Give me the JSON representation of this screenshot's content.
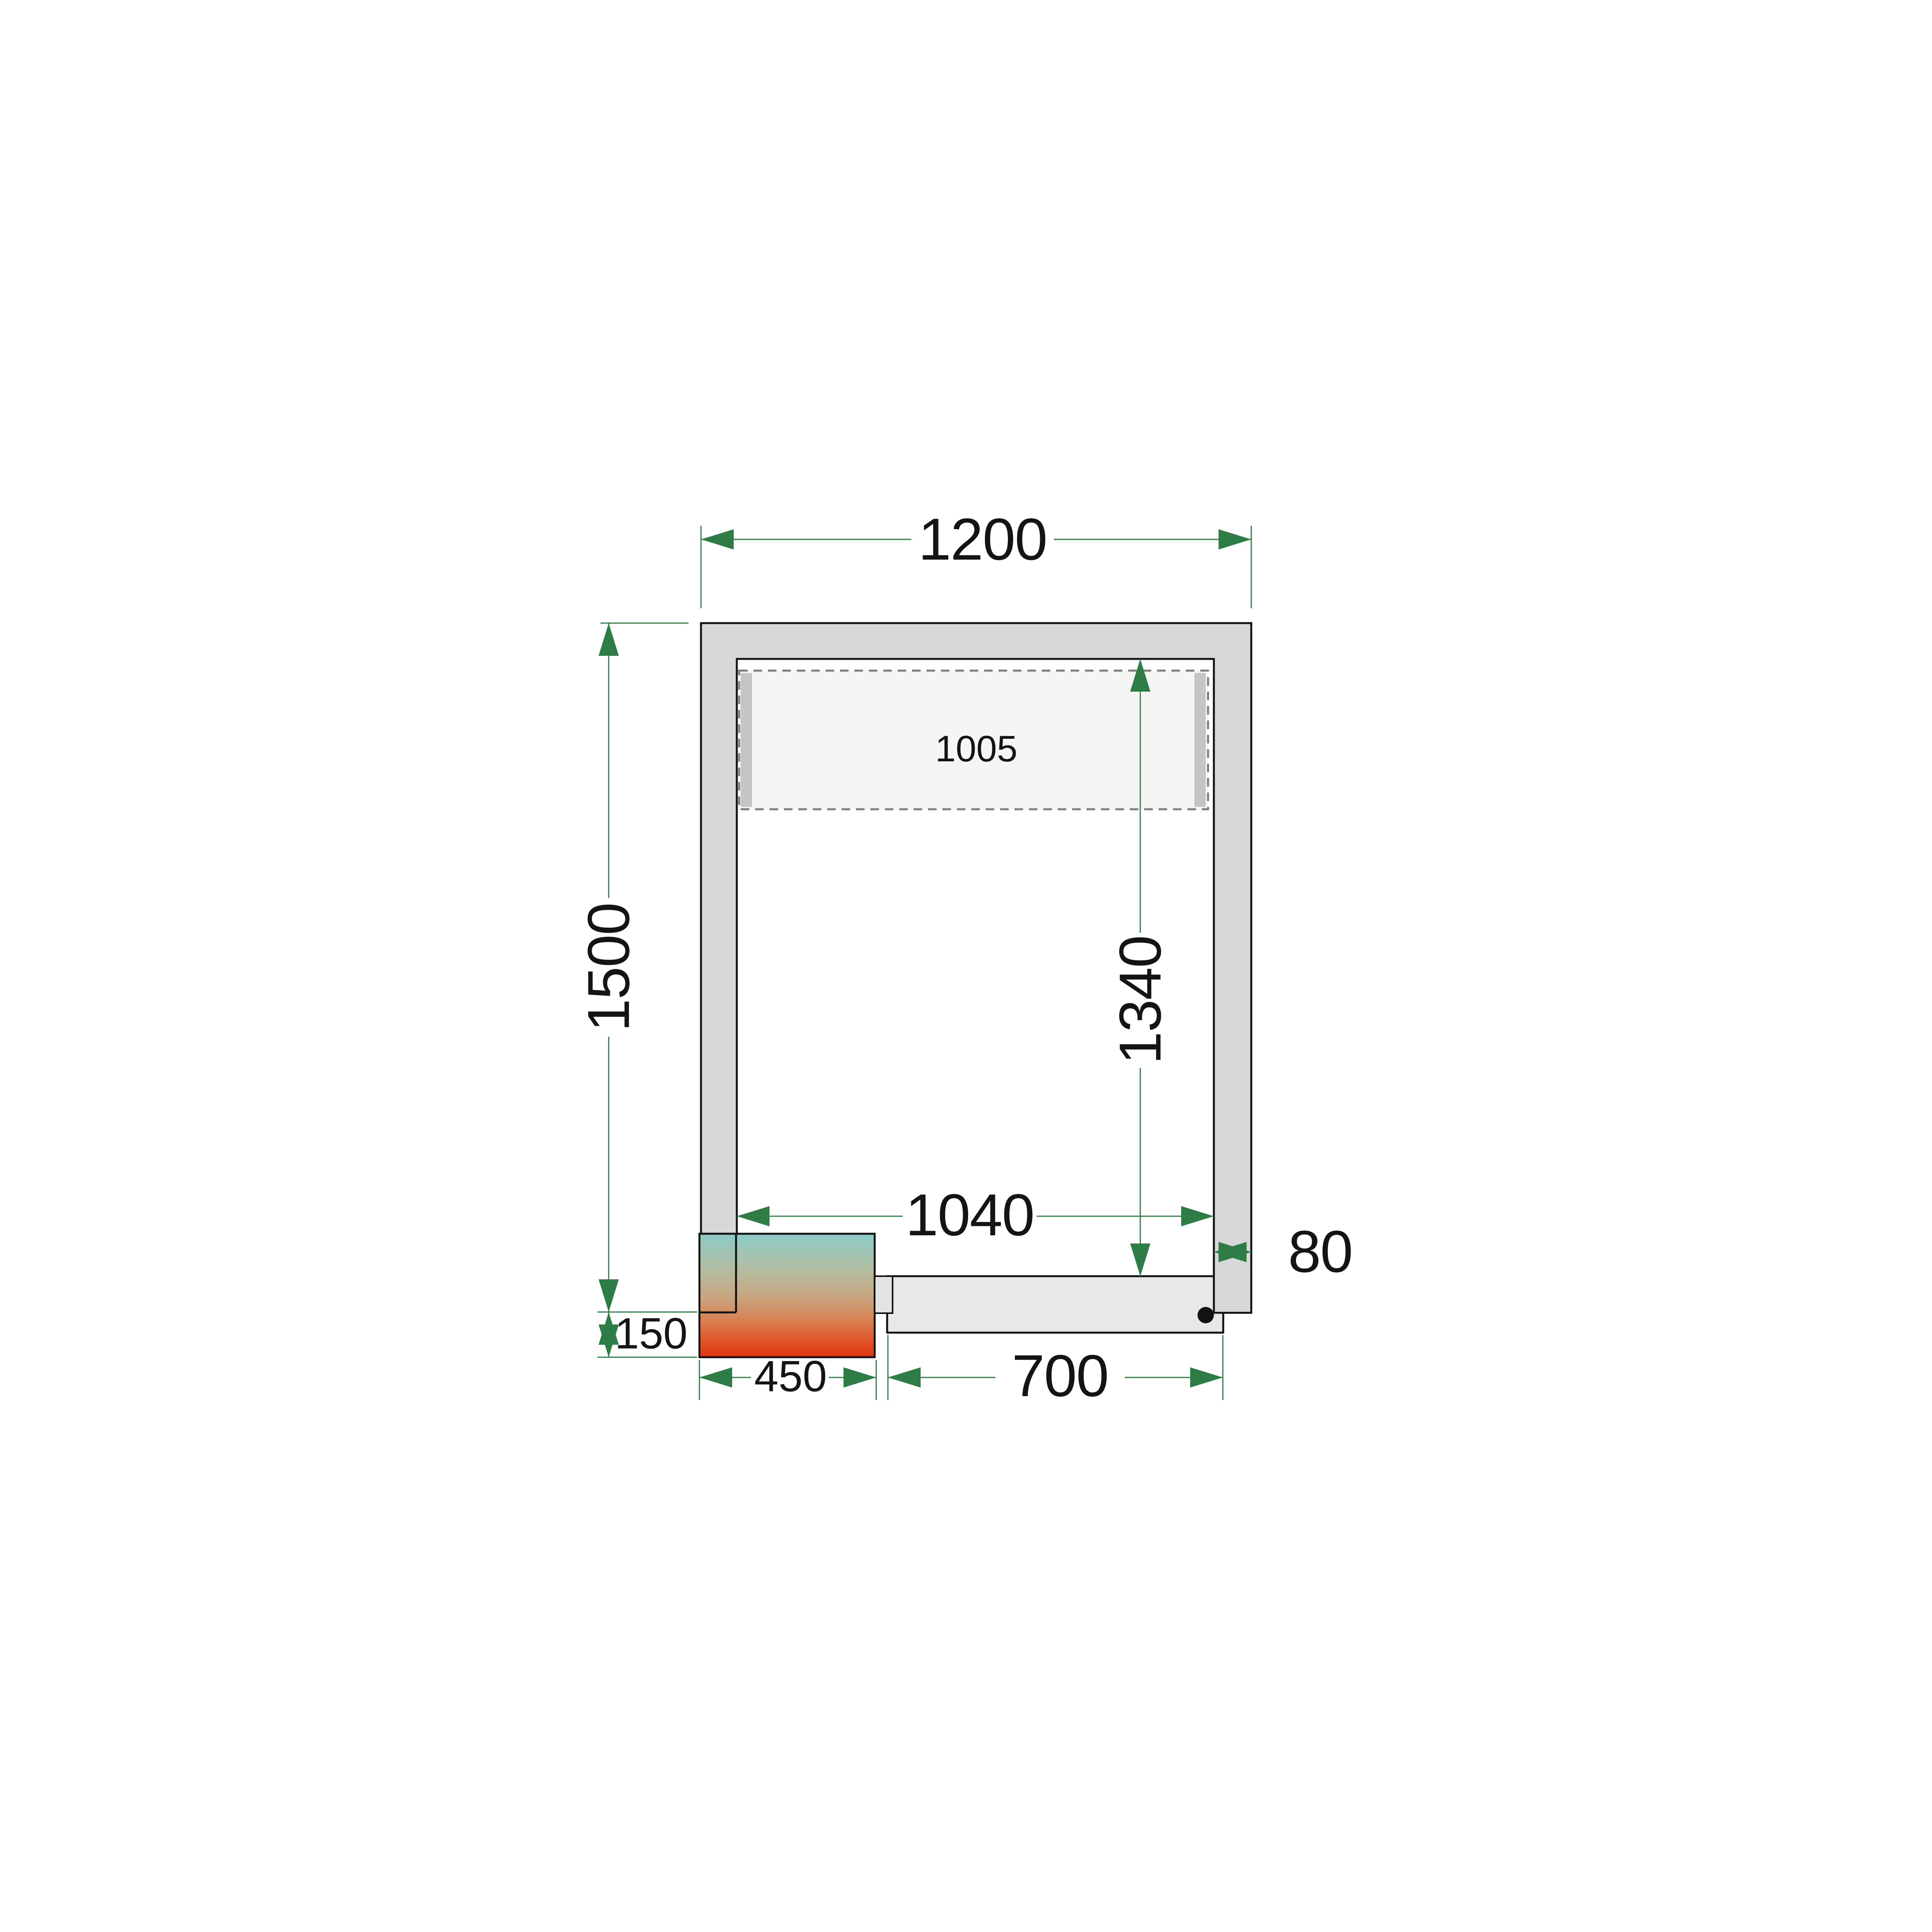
{
  "page": {
    "title": "Cold room floor plan - dimension drawing",
    "background": "#ffffff"
  },
  "drawing": {
    "kind": "cold-room-floor-plan-top-view",
    "dimensions": {
      "outer_width": {
        "label": "1200",
        "orientation": "horizontal",
        "role": "outer width of room"
      },
      "outer_depth": {
        "label": "1500",
        "orientation": "vertical",
        "role": "outer depth of room"
      },
      "inner_width": {
        "label": "1040",
        "orientation": "horizontal",
        "role": "inner width between walls"
      },
      "inner_depth": {
        "label": "1340",
        "orientation": "vertical",
        "role": "inner depth between walls"
      },
      "shelf_width": {
        "label": "1005",
        "orientation": "horizontal",
        "role": "shelf / evaporator zone width"
      },
      "wall_thickness": {
        "label": "80",
        "orientation": "horizontal",
        "role": "wall panel thickness"
      },
      "unit_width": {
        "label": "450",
        "orientation": "horizontal",
        "role": "cooling unit width"
      },
      "unit_overhang": {
        "label": "150",
        "orientation": "vertical",
        "role": "cooling unit overhang"
      },
      "door_width": {
        "label": "700",
        "orientation": "horizontal",
        "role": "door leaf width"
      }
    },
    "colors": {
      "dimension_green": "#2e7d46",
      "wall_fill": "#d8d8d8",
      "door_fill": "#e8e8e8",
      "jamb_fill": "#e3e3e3",
      "shelf_fill": "#f5f5f3",
      "shelf_support_fill": "#c5c5c5",
      "dash_gray": "#7a7a7a",
      "outline_black": "#121212",
      "unit_gradient_top": "#8ccbc7",
      "unit_gradient_mid": "#c9a57f",
      "unit_gradient_bottom": "#de3714"
    }
  }
}
